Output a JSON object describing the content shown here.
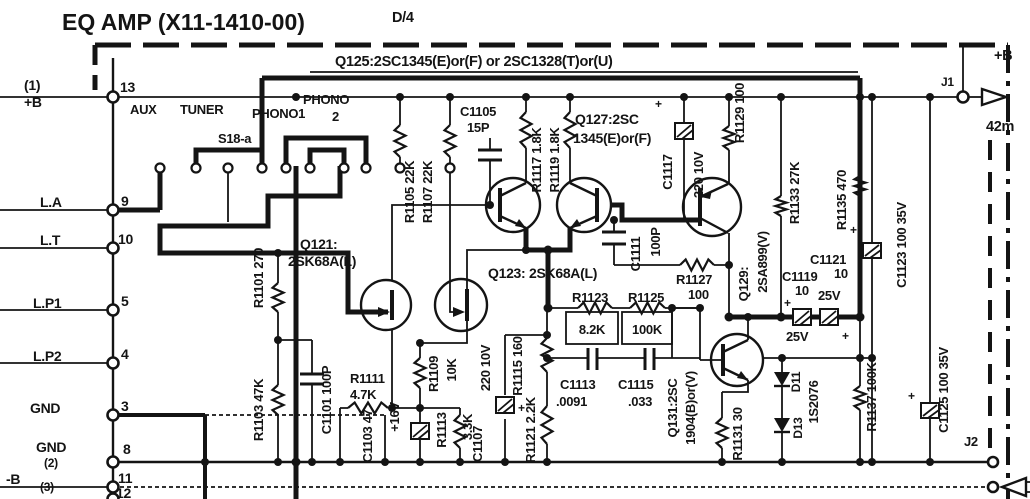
{
  "title": {
    "main": "EQ AMP (X11-1410-00)",
    "rev": "D/4"
  },
  "top_note": "Q125:2SC1345(E)or(F) or 2SC1328(T)or(U)",
  "pins": [
    {
      "name": "(1)",
      "name2": "+B",
      "num": "13"
    },
    {
      "name": "L.A",
      "num": "9"
    },
    {
      "name": "L.T",
      "num": "10"
    },
    {
      "name": "L.P1",
      "num": "5"
    },
    {
      "name": "L.P2",
      "num": "4"
    },
    {
      "name": "GND",
      "num": "3"
    },
    {
      "name": "GND",
      "name2": "(2)",
      "num": "8"
    },
    {
      "name": "-B",
      "name2": "(3)",
      "num": "11"
    },
    {
      "num": "12"
    }
  ],
  "switch": {
    "name": "S18-a",
    "aux": "AUX",
    "tuner": "TUNER",
    "phono1": "PHONO1",
    "phono2_line1": "PHONO",
    "phono2_line2": "2"
  },
  "c": {
    "r1101": "R1101 270",
    "r1103": "R1103 47K",
    "r1105": "R1105 22K",
    "r1107": "R1107 22K",
    "r1109": "R1109",
    "r1109v": "10K",
    "r1111": "R1111",
    "r1111v": "4.7K",
    "r1113": "R1113",
    "r1113v": "3.3K",
    "r1115": "R1115 160",
    "r1117": "R1117 1.8K",
    "r1119": "R1119 1.8K",
    "r1121": "R1121 2.2K",
    "r1123": "R1123",
    "r1123v": "8.2K",
    "r1125": "R1125",
    "r1125v": "100K",
    "r1127": "R1127",
    "r1127v": "100",
    "r1129": "R1129 100",
    "r1131": "R1131 30",
    "r1133": "R1133 27K",
    "r1135": "R1135 470",
    "r1137": "R1137 100K",
    "c1101": "C1101 100P",
    "c1103": "C1103 47",
    "c1103v": "+16V",
    "c1105": "C1105",
    "c1105v": "15P",
    "c1107": "C1107",
    "c1107v": "220 10V",
    "c1111": "C1111",
    "c1111v": "100P",
    "c1113": "C1113",
    "c1113v": ".0091",
    "c1115": "C1115",
    "c1115v": ".033",
    "c1117": "C1117",
    "c1117v": "220 10V",
    "c1119": "C1119",
    "c1119v": "10",
    "c1119r": "25V",
    "c1121": "C1121",
    "c1121v": "10",
    "c1121r": "25V",
    "c1123": "C1123 100 35V",
    "c1125": "C1125 100 35V",
    "d11": "D11",
    "d13": "D13",
    "dval": "1S2076",
    "q121a": "Q121:",
    "q121b": "2SK68A(L)",
    "q123": "Q123: 2SK68A(L)",
    "q127a": "Q127:2SC",
    "q127b": "1345(E)or(F)",
    "q129a": "Q129:",
    "q129b": "2SA899(V)",
    "q131a": "Q131:2SC",
    "q131b": "1904(B)or(V)"
  },
  "power": {
    "plus_b": "+B",
    "current": "42m",
    "j1": "J1",
    "j2": "J2"
  },
  "plus": "+"
}
